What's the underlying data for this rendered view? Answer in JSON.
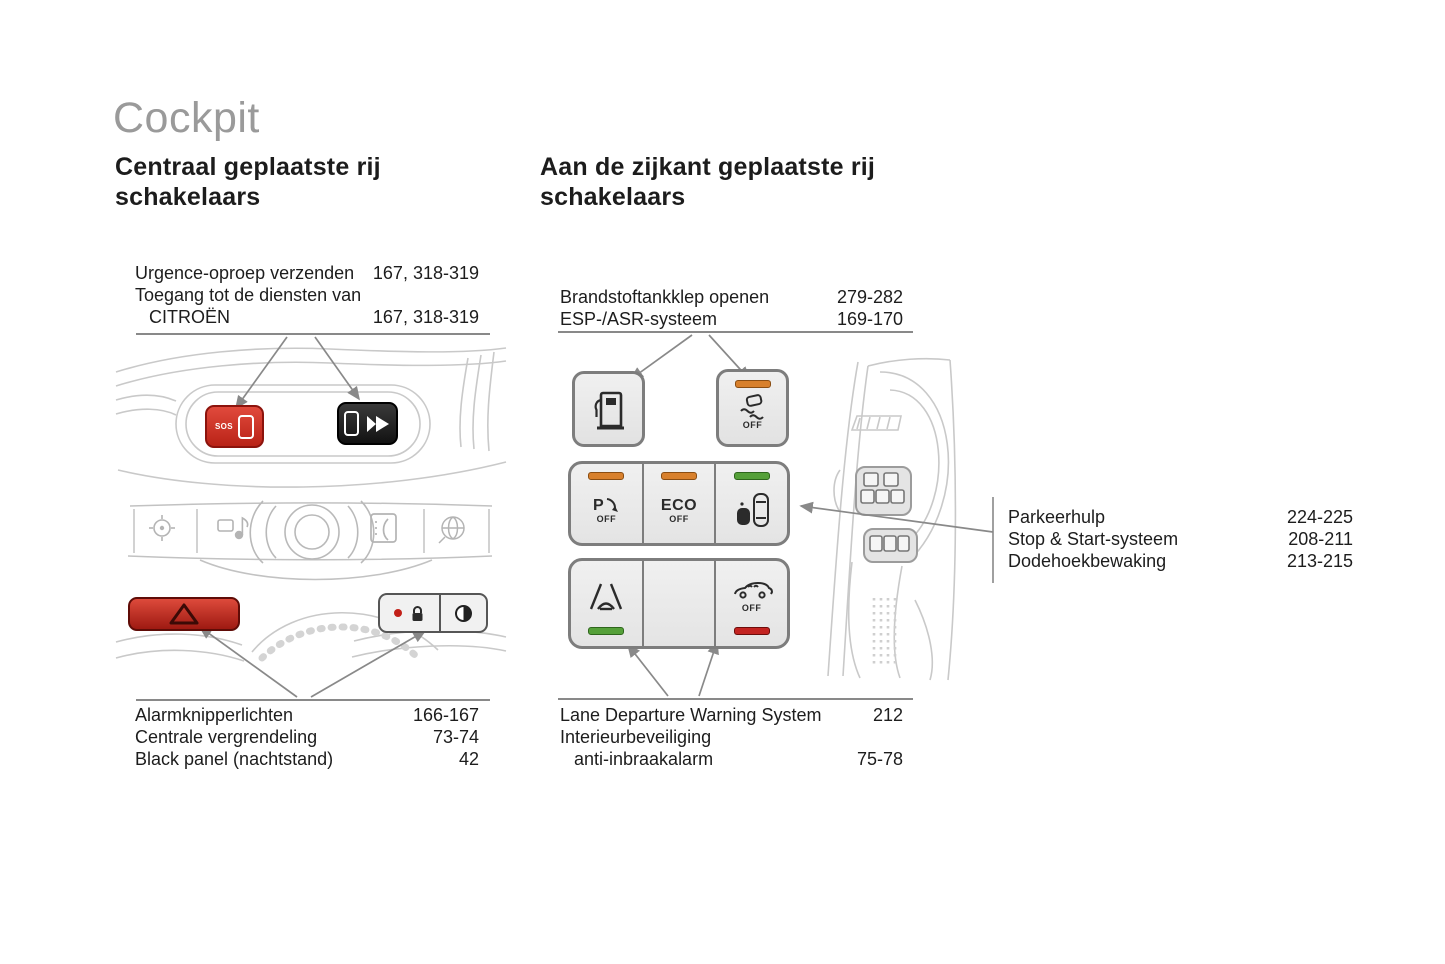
{
  "page": {
    "title": "Cockpit"
  },
  "left": {
    "heading": "Centraal geplaatste rij\nschakelaars",
    "top_refs": [
      {
        "label": "Urgence-oproep verzenden",
        "pages": "167, 318-319"
      },
      {
        "label": "Toegang tot de diensten van",
        "pages": ""
      },
      {
        "label": "CITROËN",
        "pages": "167, 318-319"
      }
    ],
    "bottom_refs": [
      {
        "label": "Alarmknipperlichten",
        "pages": "166-167"
      },
      {
        "label": "Centrale vergrendeling",
        "pages": "73-74"
      },
      {
        "label": "Black panel (nachtstand)",
        "pages": "42"
      }
    ],
    "sos_button": {
      "label": "SOS"
    }
  },
  "right": {
    "heading": "Aan de zijkant geplaatste rij\nschakelaars",
    "top_refs": [
      {
        "label": "Brandstoftankklep openen",
        "pages": "279-282"
      },
      {
        "label": "ESP-/ASR-systeem",
        "pages": "169-170"
      }
    ],
    "side_refs": [
      {
        "label": "Parkeerhulp",
        "pages": "224-225"
      },
      {
        "label": "Stop & Start-systeem",
        "pages": "208-211"
      },
      {
        "label": "Dodehoekbewaking",
        "pages": "213-215"
      }
    ],
    "bottom_refs": [
      {
        "label": "Lane Departure Warning System",
        "pages": "212"
      },
      {
        "label": "Interieurbeveiliging",
        "pages": ""
      },
      {
        "label": "anti-inbraakalarm",
        "pages": "75-78"
      }
    ],
    "buttons": {
      "esp": {
        "off": "OFF"
      },
      "park_assist": {
        "letter": "P",
        "off": "OFF"
      },
      "eco": {
        "label": "ECO",
        "off": "OFF"
      },
      "interior": {
        "off": "OFF"
      }
    }
  },
  "icons": {
    "sos-phone-icon": "white rounded rect",
    "ds-logo-icon": "double chevron",
    "hazard-triangle-icon": "warning triangle outline",
    "lock-icon": "padlock",
    "black-panel-icon": "half-filled circle",
    "nav-crosshair-icon": "crosshair",
    "media-icon": "disc + note",
    "volume-knob-icon": "concentric circles",
    "phone-icon": "handset in rect",
    "internet-globe-icon": "globe",
    "fuel-flap-icon": "fuel pump",
    "esp-off-icon": "skidding car",
    "park-assist-off-icon": "P with sensor arrow",
    "blind-spot-icon": "two cars top view",
    "lane-departure-icon": "car between lane lines",
    "interior-protection-off-icon": "car side with waves"
  },
  "colors": {
    "title_gray": "#9a9a9a",
    "text": "#1a1a1a",
    "line_gray": "#898989",
    "sketch_gray": "#c9c9c9",
    "button_red": "#c8271c",
    "button_black": "#1d1d1d",
    "panel_gray": "#ececec",
    "indicator_orange": "#d8802c",
    "indicator_green": "#55a039",
    "indicator_red": "#c32421"
  }
}
